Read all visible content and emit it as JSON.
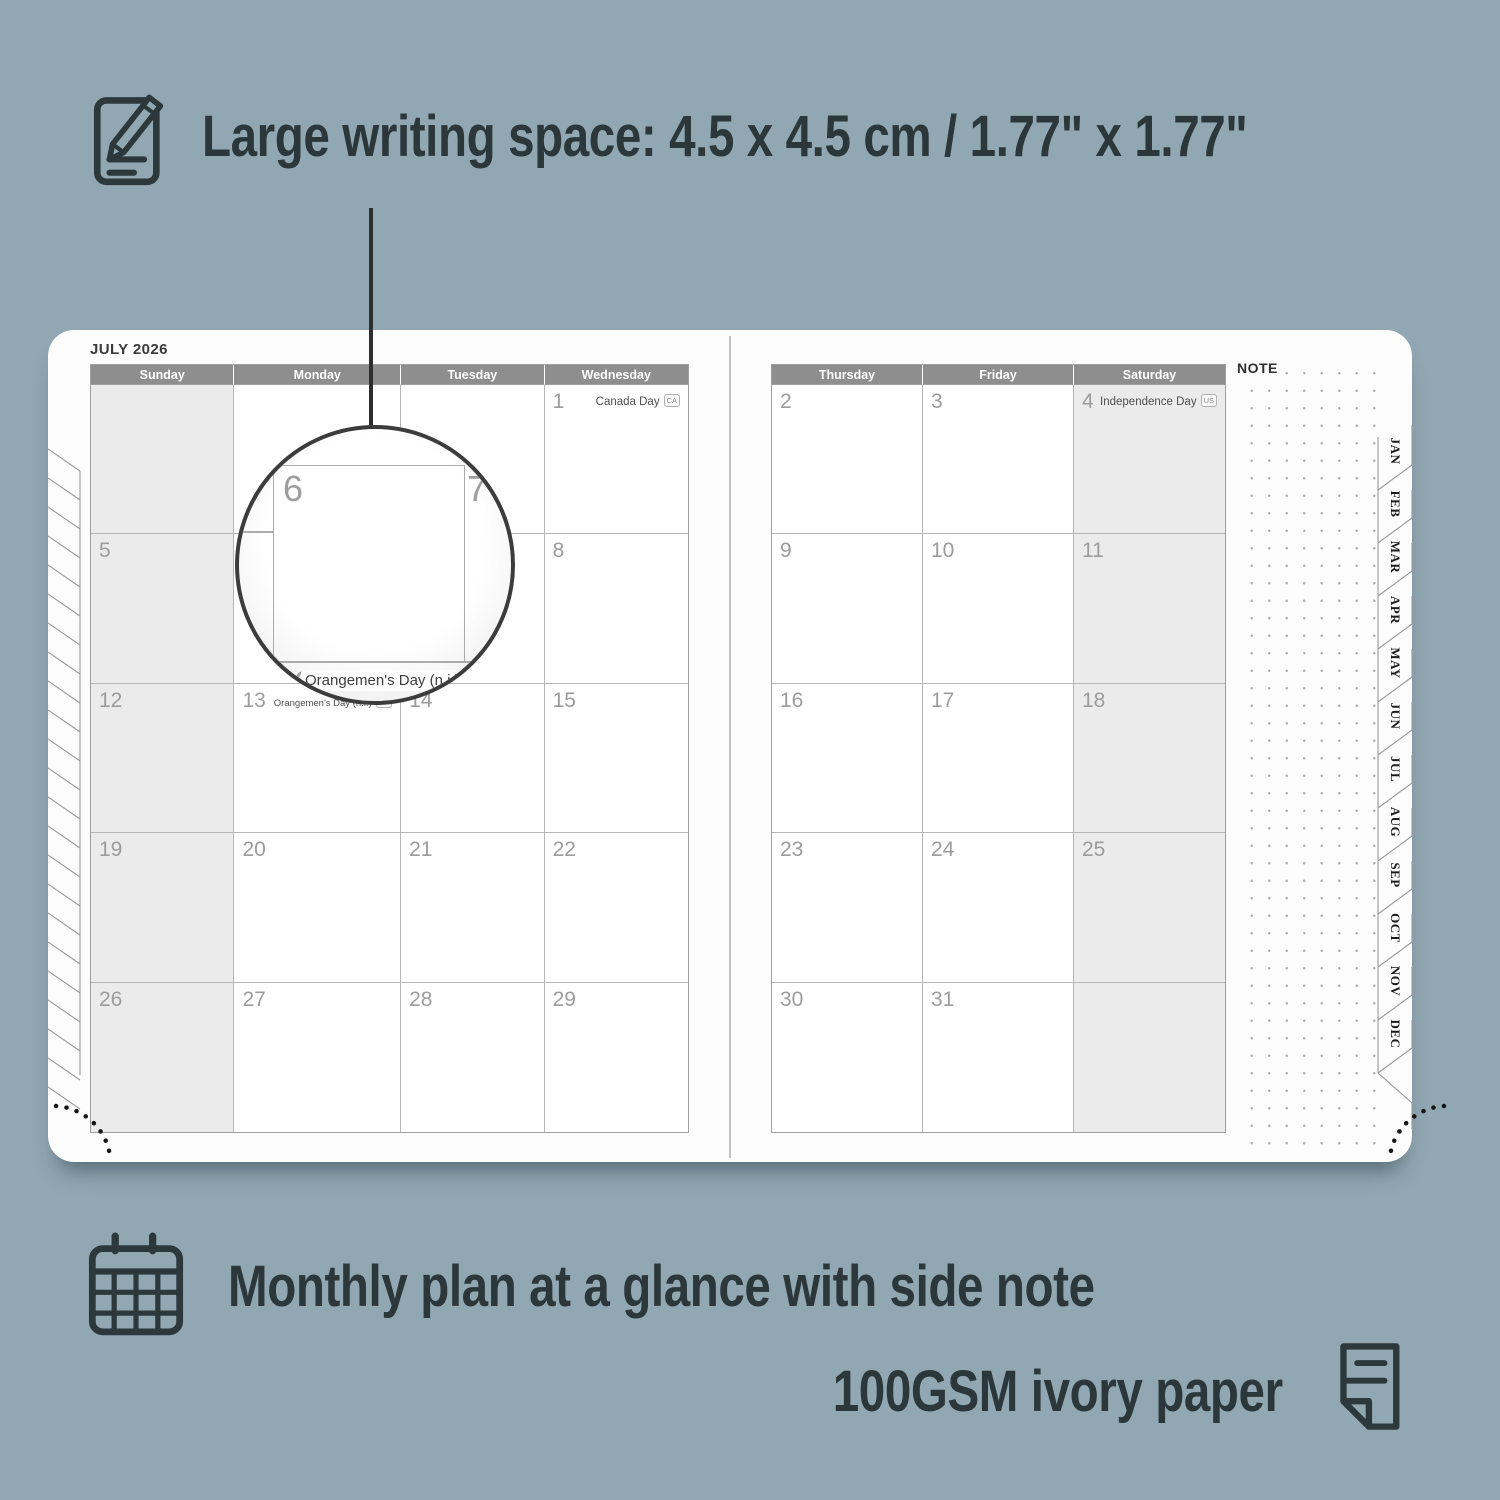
{
  "colors": {
    "background": "#91a7b2",
    "ink": "#2c373b",
    "page": "#fcfcfc",
    "header_bar": "#8e8e8e",
    "shaded_cell": "#ebebeb",
    "grid_line": "#b6b6b6",
    "day_number": "#9c9c9c"
  },
  "features": {
    "writing_space": "Large writing space: 4.5 x 4.5 cm / 1.77\" x 1.77\"",
    "monthly_plan": "Monthly plan at a glance with side note",
    "paper": "100GSM ivory paper"
  },
  "planner": {
    "month_title": "JULY 2026",
    "note_label": "NOTE",
    "month_tabs": [
      "JAN",
      "FEB",
      "MAR",
      "APR",
      "MAY",
      "JUN",
      "JUL",
      "AUG",
      "SEP",
      "OCT",
      "NOV",
      "DEC"
    ],
    "left_page": {
      "headers": [
        "Sunday",
        "Monday",
        "Tuesday",
        "Wednesday"
      ],
      "shaded_column": 0,
      "rows": [
        [
          {
            "d": ""
          },
          {
            "d": ""
          },
          {
            "d": ""
          },
          {
            "d": "1",
            "holiday": "Canada Day",
            "badge": "CA"
          }
        ],
        [
          {
            "d": "5"
          },
          {
            "d": "6"
          },
          {
            "d": "7"
          },
          {
            "d": "8"
          }
        ],
        [
          {
            "d": "12"
          },
          {
            "d": "13",
            "holiday": "Orangemen's Day (n.i.)",
            "badge": "UK",
            "inline": true
          },
          {
            "d": "14"
          },
          {
            "d": "15"
          }
        ],
        [
          {
            "d": "19"
          },
          {
            "d": "20"
          },
          {
            "d": "21"
          },
          {
            "d": "22"
          }
        ],
        [
          {
            "d": "26"
          },
          {
            "d": "27"
          },
          {
            "d": "28"
          },
          {
            "d": "29"
          }
        ]
      ]
    },
    "right_page": {
      "headers": [
        "Thursday",
        "Friday",
        "Saturday"
      ],
      "shaded_column": 2,
      "rows": [
        [
          {
            "d": "2"
          },
          {
            "d": "3"
          },
          {
            "d": "4",
            "holiday": "Independence Day",
            "badge": "US"
          }
        ],
        [
          {
            "d": "9"
          },
          {
            "d": "10"
          },
          {
            "d": "11"
          }
        ],
        [
          {
            "d": "16"
          },
          {
            "d": "17"
          },
          {
            "d": "18"
          }
        ],
        [
          {
            "d": "23"
          },
          {
            "d": "24"
          },
          {
            "d": "25"
          }
        ],
        [
          {
            "d": "30"
          },
          {
            "d": "31"
          },
          {
            "d": ""
          }
        ]
      ]
    }
  },
  "magnifier": {
    "day_top_left": "6",
    "day_top_right": "7",
    "day_bottom": "13",
    "holiday": "Orangemen's Day (n.i.)",
    "badge": "UK"
  }
}
